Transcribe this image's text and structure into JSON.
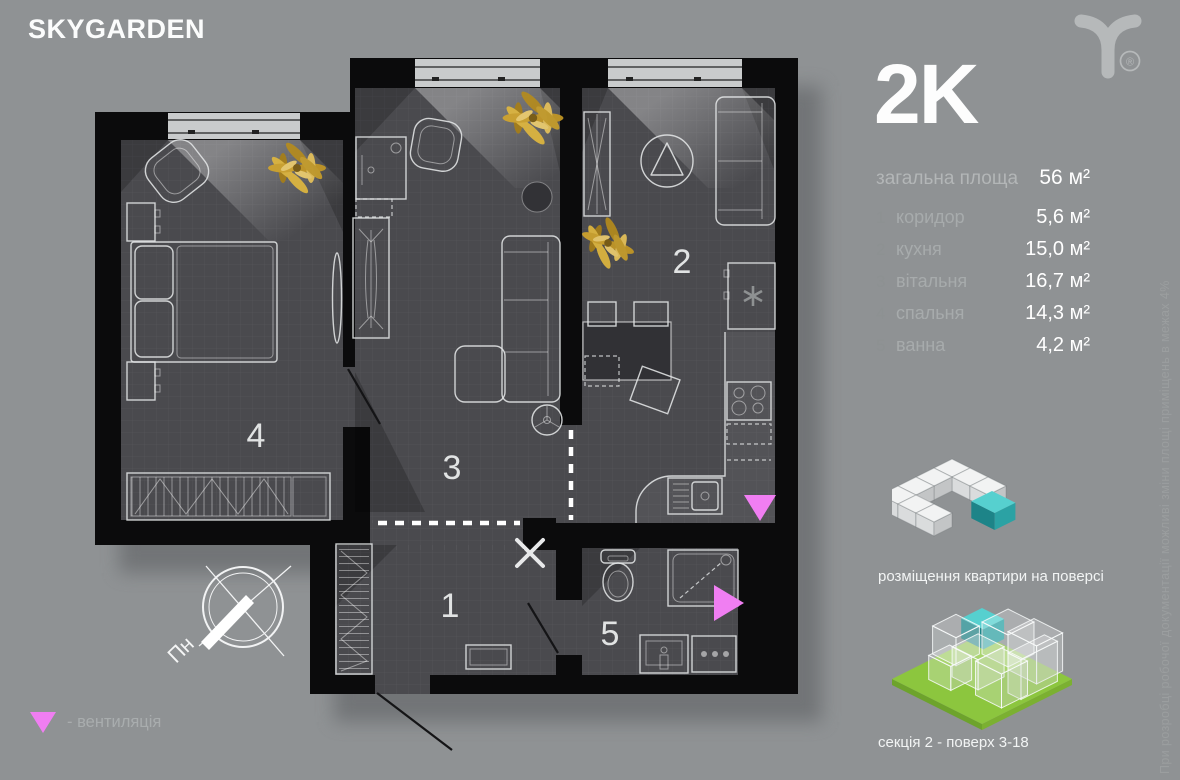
{
  "brand": {
    "name": "SKYGARDEN",
    "registered_mark": "®"
  },
  "apartment": {
    "type_label": "2K",
    "total": {
      "label": "загальна площа",
      "value": "56 м²"
    },
    "rooms": [
      {
        "num": "1",
        "name": "коридор",
        "area": "5,6 м²"
      },
      {
        "num": "2",
        "name": "кухня",
        "area": "15,0 м²"
      },
      {
        "num": "3",
        "name": "вітальня",
        "area": "16,7 м²"
      },
      {
        "num": "4",
        "name": "спальня",
        "area": "14,3 м²"
      },
      {
        "num": "5",
        "name": "ванна",
        "area": "4,2 м²"
      }
    ]
  },
  "plan": {
    "room_labels": [
      "1",
      "2",
      "3",
      "4",
      "5"
    ],
    "compass_label": "Пн"
  },
  "legend": {
    "vent_label": "- вентиляція"
  },
  "captions": {
    "floor_position": "розміщення квартири на поверсі",
    "section_floors": "секція 2 - поверх 3-18"
  },
  "disclaimer": "При розробці робочої документації можливі зміни площі приміщень в межах 4%",
  "colors": {
    "background": "#8f9294",
    "walls": "#0b0b0c",
    "floor": "#4a4a4e",
    "vent_pink": "#f07ef2",
    "accent_teal": "#45c8cc",
    "section_green": "#8cc63e"
  }
}
